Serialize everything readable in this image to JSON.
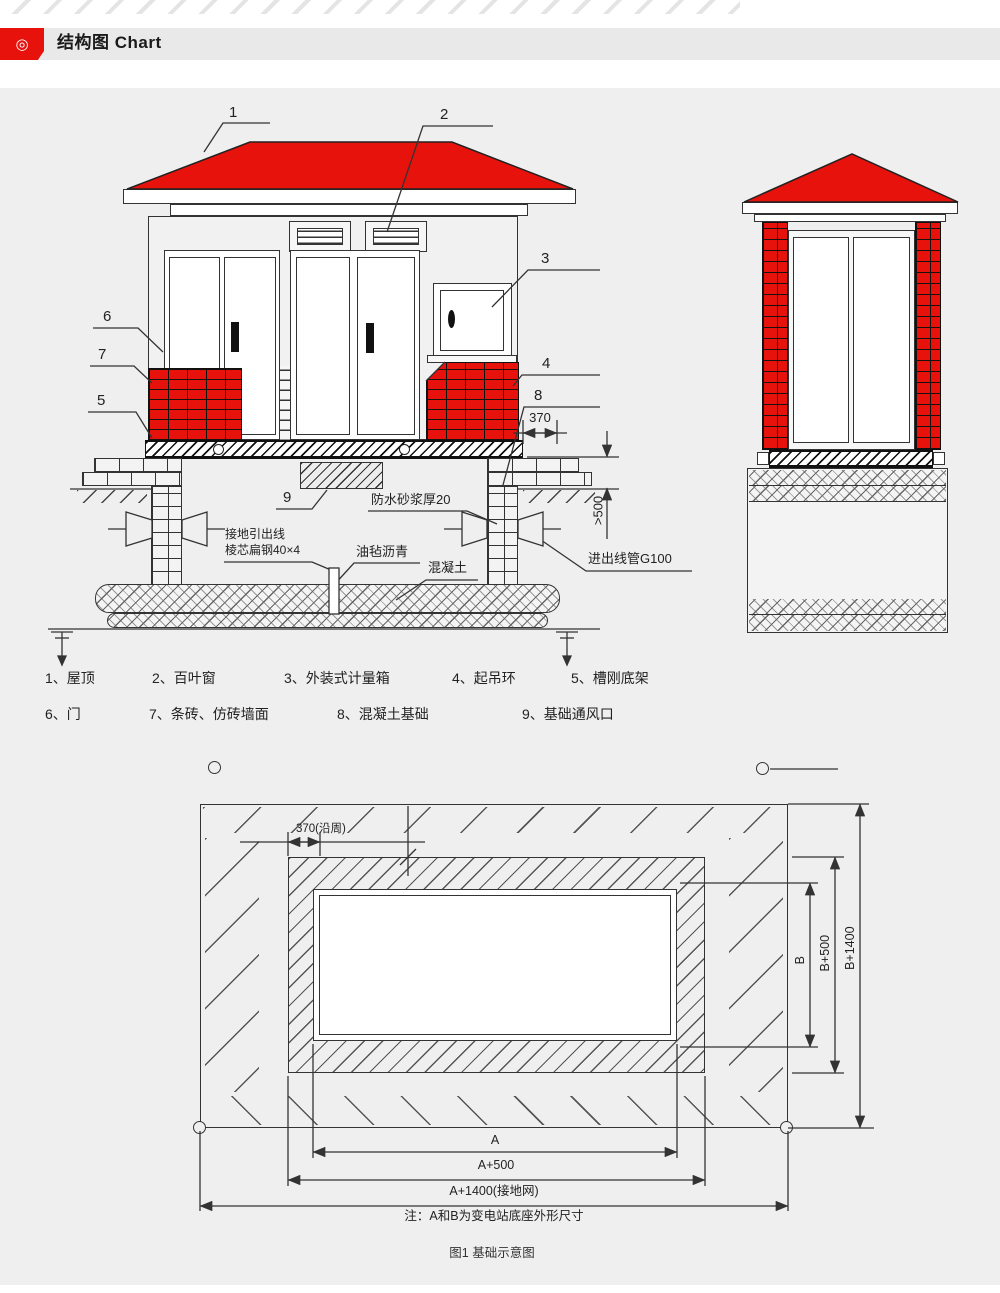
{
  "header": {
    "title": "结构图 Chart",
    "icon": "target-circle-icon"
  },
  "colors": {
    "accent_red": "#e8120c",
    "panel_bg": "#efefef",
    "line": "#333333"
  },
  "legend": {
    "row1": [
      "1、屋顶",
      "2、百叶窗",
      "3、外装式计量箱",
      "4、起吊环",
      "5、槽刚底架"
    ],
    "row2": [
      "6、门",
      "7、条砖、仿砖墙面",
      "8、混凝土基础",
      "9、基础通风口"
    ]
  },
  "elevation": {
    "c1": "1",
    "c2": "2",
    "c3": "3",
    "c4": "4",
    "c5": "5",
    "c6": "6",
    "c7": "7",
    "c8": "8",
    "c9": "9",
    "waterproof": "防水砂浆厚20",
    "ground1": "接地引出线",
    "ground2": "棱芯扁钢40×4",
    "felt": "油毡沥青",
    "concrete": "混凝土",
    "conduit": "进出线管G100",
    "dim370": "370",
    "dim500": ">500"
  },
  "plan": {
    "dim370": "370(沿周)",
    "a": "A",
    "a500": "A+500",
    "a1400": "A+1400(接地网)",
    "b": "B",
    "b500": "B+500",
    "b1400": "B+1400",
    "note": "注：A和B为变电站底座外形尺寸"
  },
  "caption": "图1 基础示意图"
}
